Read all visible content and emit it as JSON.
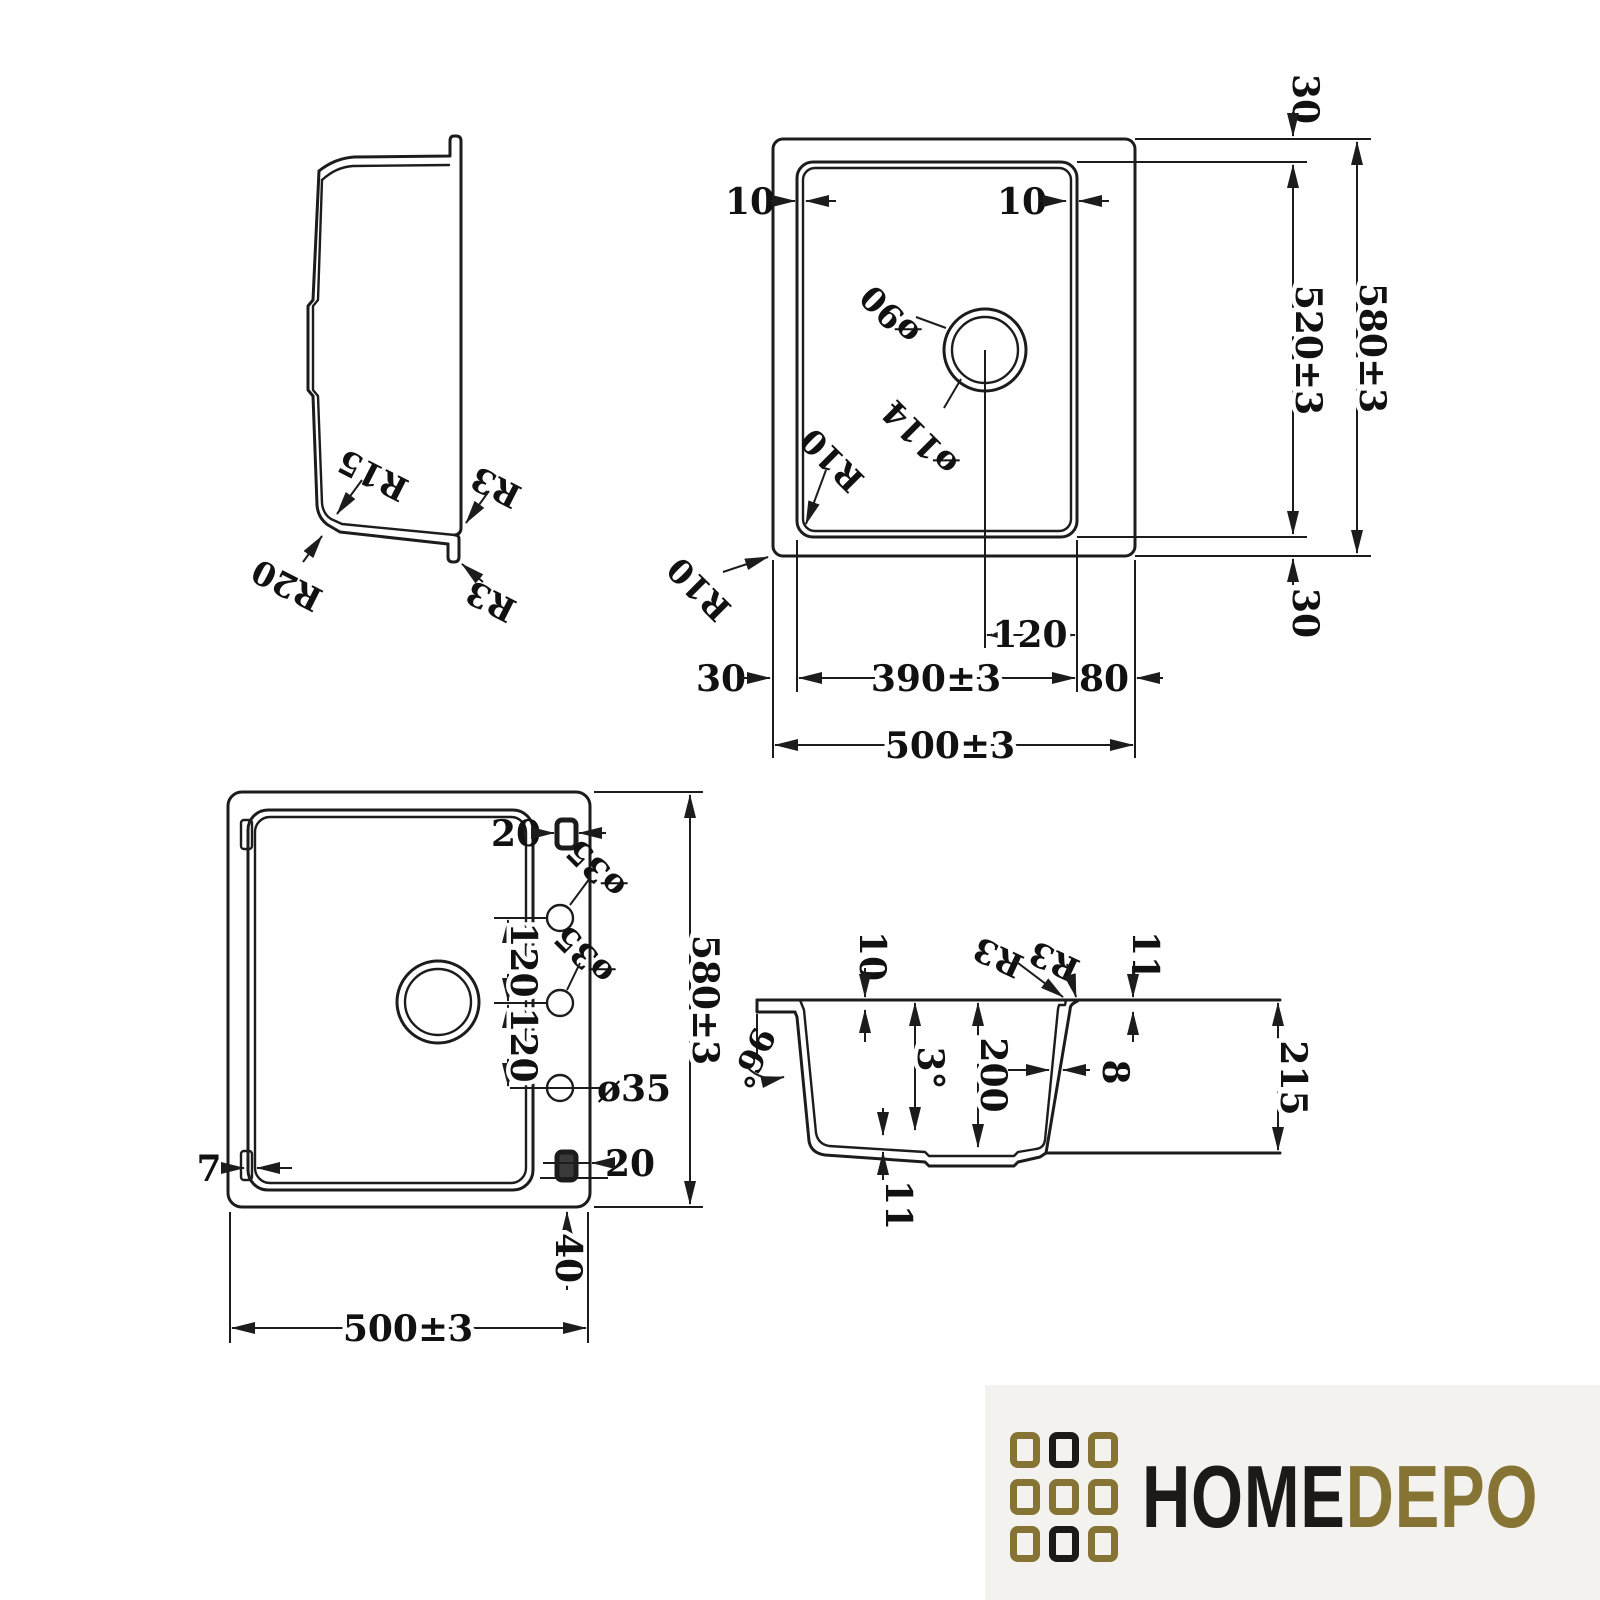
{
  "side_view": {
    "r15": "R15",
    "r20": "R20",
    "r3_top": "R3",
    "r3_bottom": "R3"
  },
  "top_view": {
    "dim_10_left": "10",
    "dim_10_right": "10",
    "dia_90": "ø90",
    "dia_114": "ø114",
    "r10_inner": "R10",
    "r10_outer": "R10",
    "dim_30_top": "30",
    "dim_520": "520±3",
    "dim_580": "580±3",
    "dim_30_bottom": "30",
    "dim_120": "120",
    "dim_30_left": "30",
    "dim_390": "390±3",
    "dim_80": "80",
    "dim_500": "500±3"
  },
  "bottom_view": {
    "dim_20_top": "20",
    "dia_35_a": "ø35",
    "dia_35_b": "ø35",
    "dia_35_c": "ø35",
    "dim_120_a": "120",
    "dim_120_b": "120",
    "dim_580": "580±3",
    "dim_7": "7",
    "dim_20_bottom": "20",
    "dim_40": "40",
    "dim_500": "500±3"
  },
  "section_view": {
    "dim_10": "10",
    "r3_a": "R3",
    "r3_b": "R3",
    "dim_11_top": "11",
    "angle_96": "96°",
    "angle_3": "3°",
    "dim_200": "200",
    "dim_8": "8",
    "dim_215": "215",
    "dim_11_bottom": "11"
  },
  "logo": {
    "home": "HOME",
    "depo": "DEPO",
    "colors": {
      "gold": "#857434",
      "ink": "#1b1a17"
    }
  }
}
